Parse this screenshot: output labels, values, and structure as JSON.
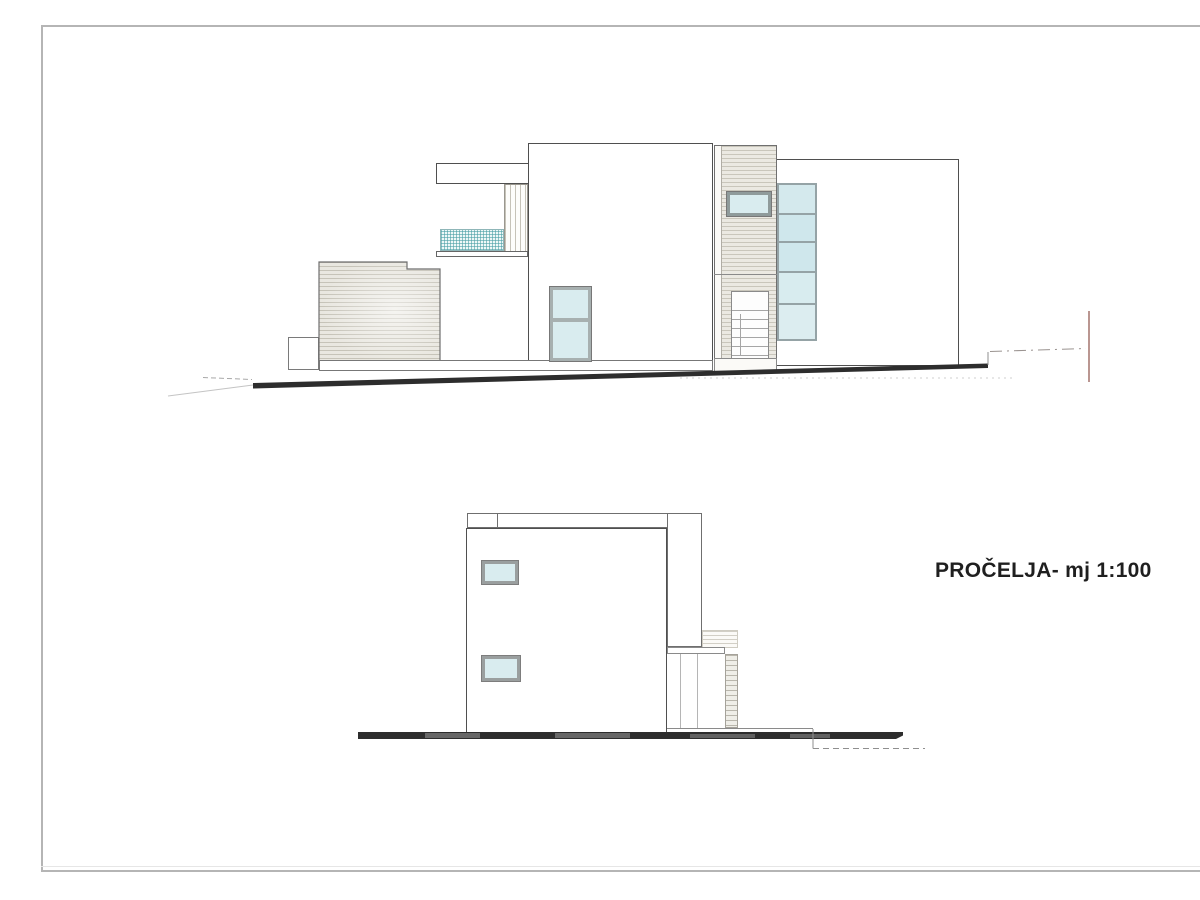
{
  "drawing": {
    "title": "PROČELJA- mj 1:100"
  },
  "colors": {
    "paper": "#ffffff",
    "frame": "#b5b5b5",
    "text": "#1f1f1f",
    "outline-dark": "#4f4f4f",
    "outline-mid": "#8a8a8a",
    "cladding-fill": "#e9e7e0",
    "cladding-line": "#c6c3b8",
    "glass-fill": "#d9ecef",
    "glass-frame": "#95a3a6",
    "railing-teal": "#7fc7cc",
    "ground-dark": "#2d2d2d",
    "marker-red": "#a3736c"
  }
}
